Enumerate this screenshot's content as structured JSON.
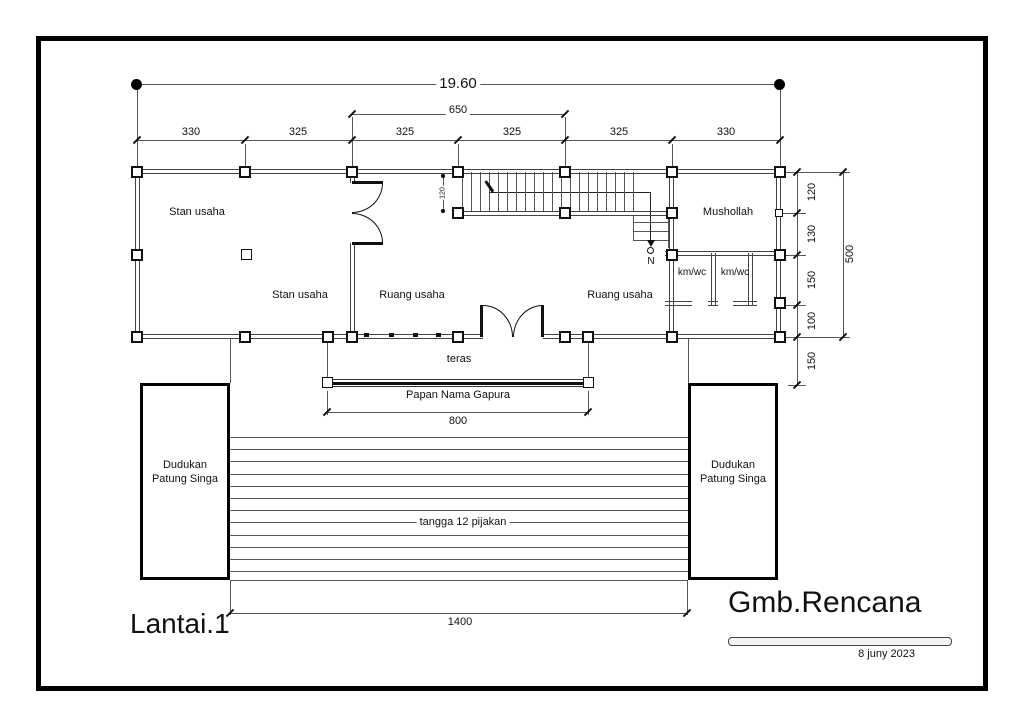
{
  "colors": {
    "ink": "#111111",
    "wall_line": "#555555",
    "background": "#ffffff"
  },
  "labels": {
    "rooms": {
      "stan_usaha_top": "Stan usaha",
      "stan_usaha_bottom": "Stan usaha",
      "ruang_usaha_left": "Ruang usaha",
      "ruang_usaha_right": "Ruang usaha",
      "mushollah": "Mushollah",
      "kmwc_left": "km/wc",
      "kmwc_right": "km/wc",
      "teras": "teras"
    },
    "annotations": {
      "papan_nama": "Papan Nama Gapura",
      "tangga": "tangga 12 pijakan",
      "stair_direction": "N"
    },
    "dudukan_left": {
      "line1": "Dudukan",
      "line2": "Patung Singa"
    },
    "dudukan_right": {
      "line1": "Dudukan",
      "line2": "Patung Singa"
    },
    "title_block": {
      "floor_label": "Lantai.1",
      "drawing_title": "Gmb.Rencana",
      "date": "8 juny 2023"
    }
  },
  "dimensions": {
    "overall_width": "19.60",
    "span_650": "650",
    "top_row": [
      "330",
      "325",
      "325",
      "325",
      "325",
      "330"
    ],
    "right_col": [
      "120",
      "130",
      "150",
      "100",
      "150"
    ],
    "right_total": "500",
    "stair_width": "120",
    "papan_width": "800",
    "bottom_stairs_width": "1400"
  }
}
